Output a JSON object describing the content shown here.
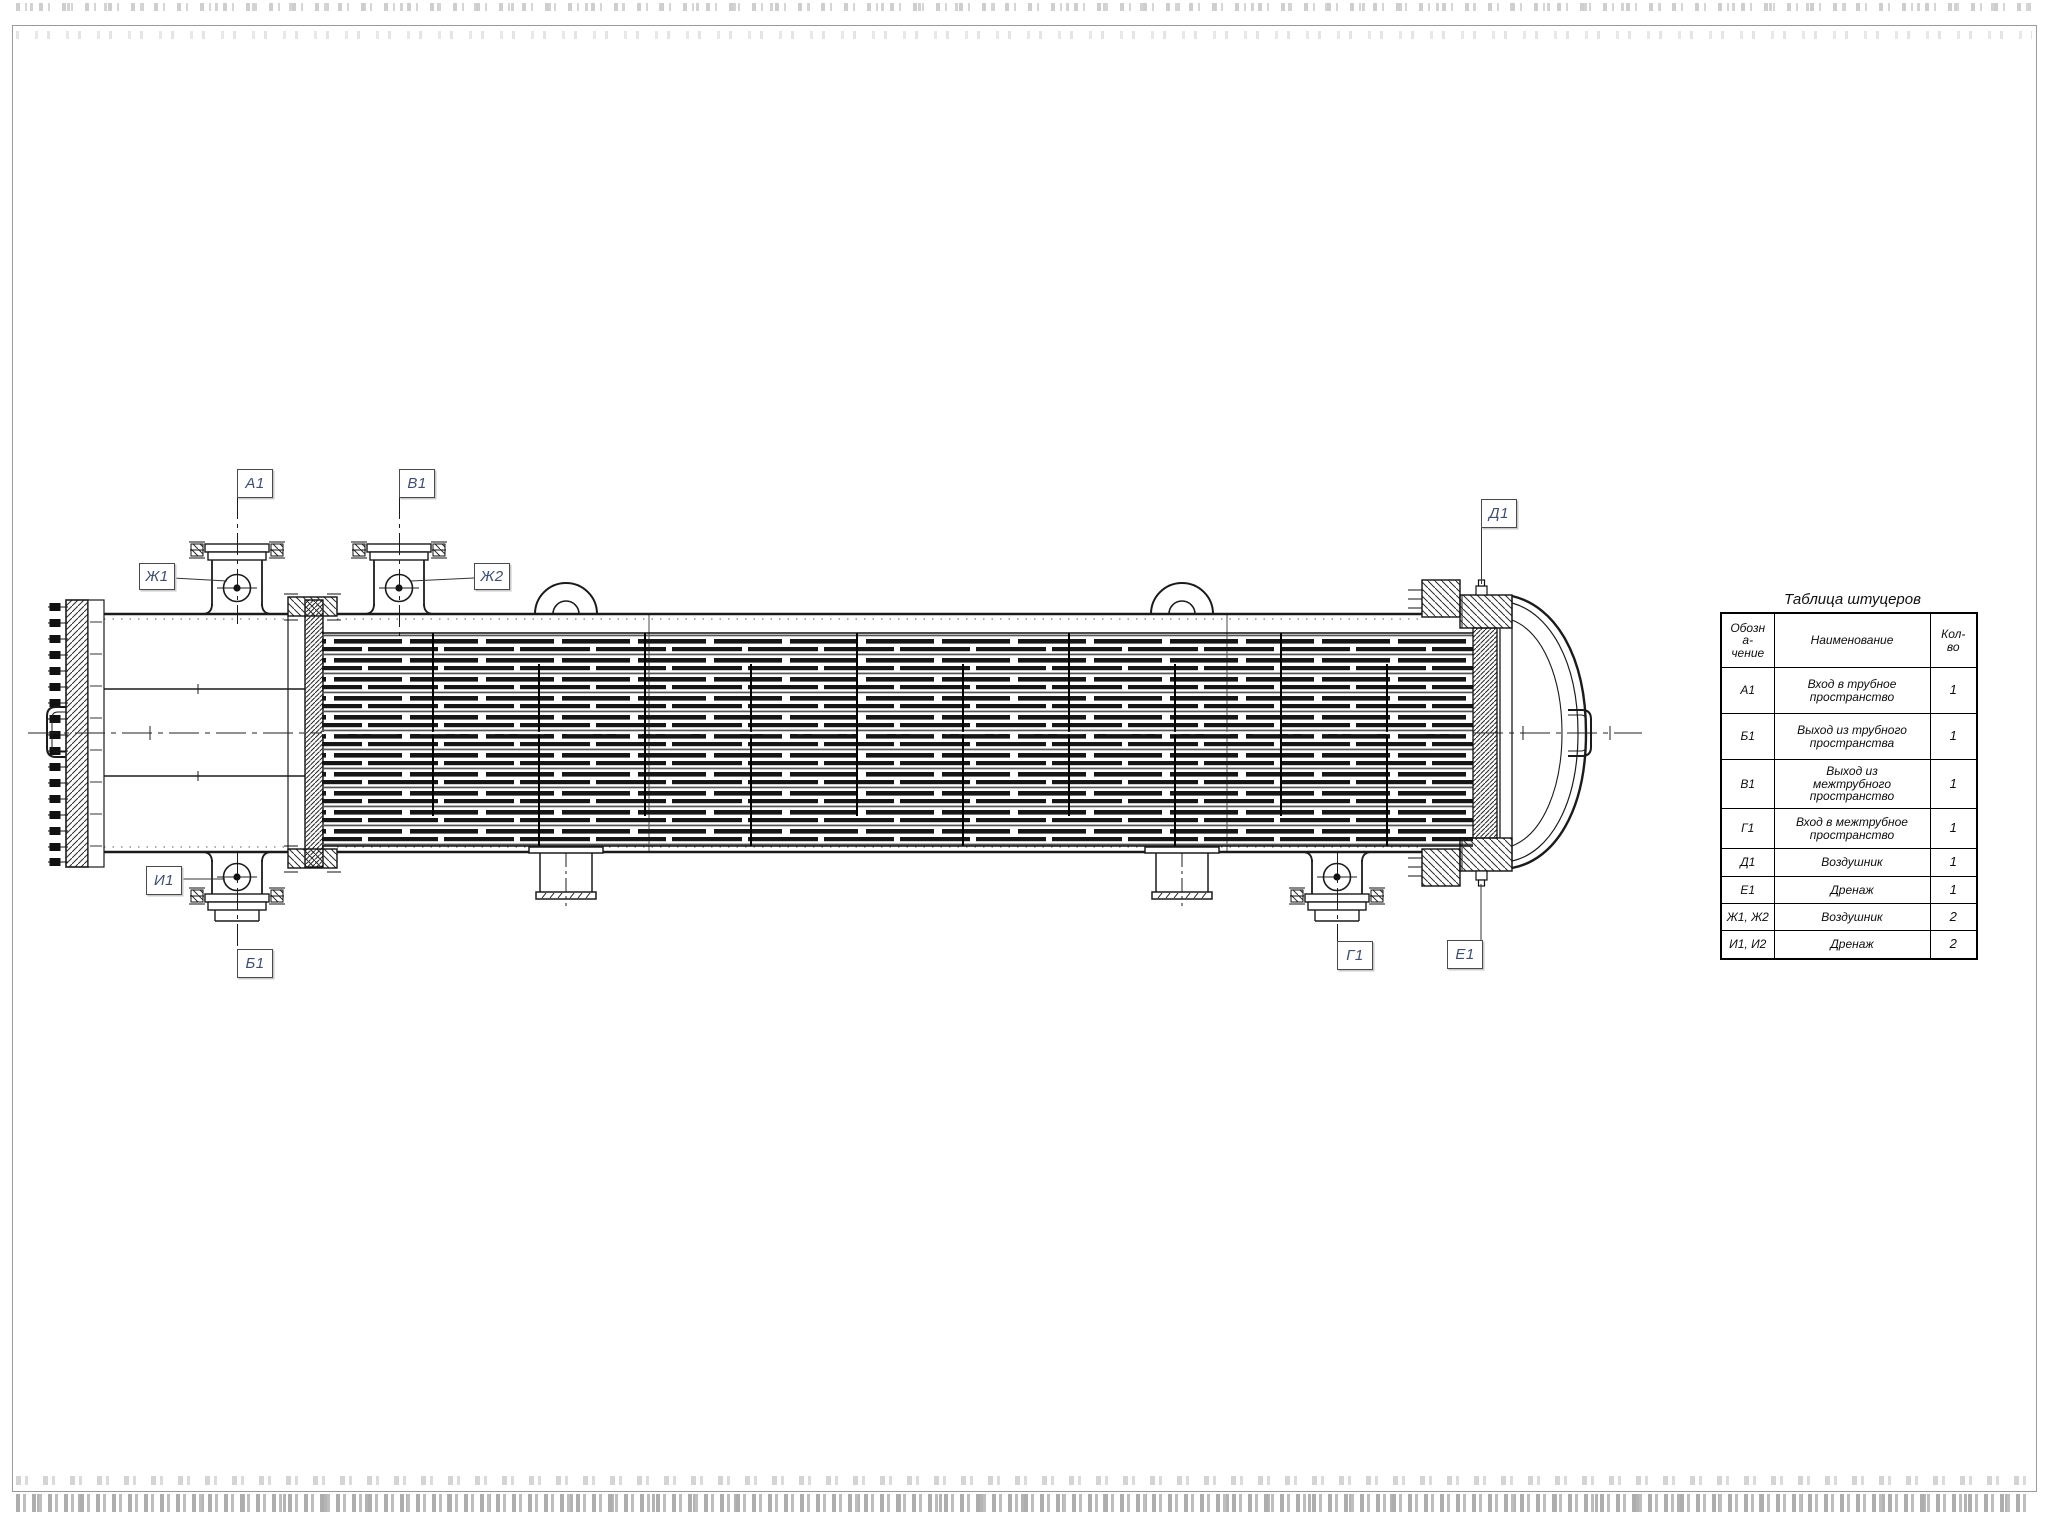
{
  "table": {
    "title": "Таблица штуцеров",
    "header": {
      "designation": [
        "Обозн",
        "а-",
        "чение"
      ],
      "name": "Наименование",
      "qty": [
        "Кол-",
        "во"
      ]
    },
    "rows": [
      {
        "des": "А1",
        "name": [
          "Вход в трубное",
          "пространство"
        ],
        "qty": "1"
      },
      {
        "des": "Б1",
        "name": [
          "Выход из трубного",
          "пространства"
        ],
        "qty": "1"
      },
      {
        "des": "В1",
        "name": [
          "Выход из",
          "межтрубного",
          "пространство"
        ],
        "qty": "1"
      },
      {
        "des": "Г1",
        "name": [
          "Вход в межтрубное",
          "пространство"
        ],
        "qty": "1"
      },
      {
        "des": "Д1",
        "name": [
          "Воздушник"
        ],
        "qty": "1"
      },
      {
        "des": "Е1",
        "name": [
          "Дренаж"
        ],
        "qty": "1"
      },
      {
        "des": "Ж1, Ж2",
        "name": [
          "Воздушник"
        ],
        "qty": "2"
      },
      {
        "des": "И1, И2",
        "name": [
          "Дренаж"
        ],
        "qty": "2"
      }
    ]
  },
  "callouts": {
    "a1": "А1",
    "b1": "В1",
    "zh1": "Ж1",
    "zh2": "Ж2",
    "d1": "Д1",
    "i1": "И1",
    "b1out": "Б1",
    "g1": "Г1",
    "e1": "Е1"
  },
  "colors": {
    "line": "#1b1b1b",
    "callout_text": "#3d4e71",
    "frame": "#9a9a9a"
  }
}
